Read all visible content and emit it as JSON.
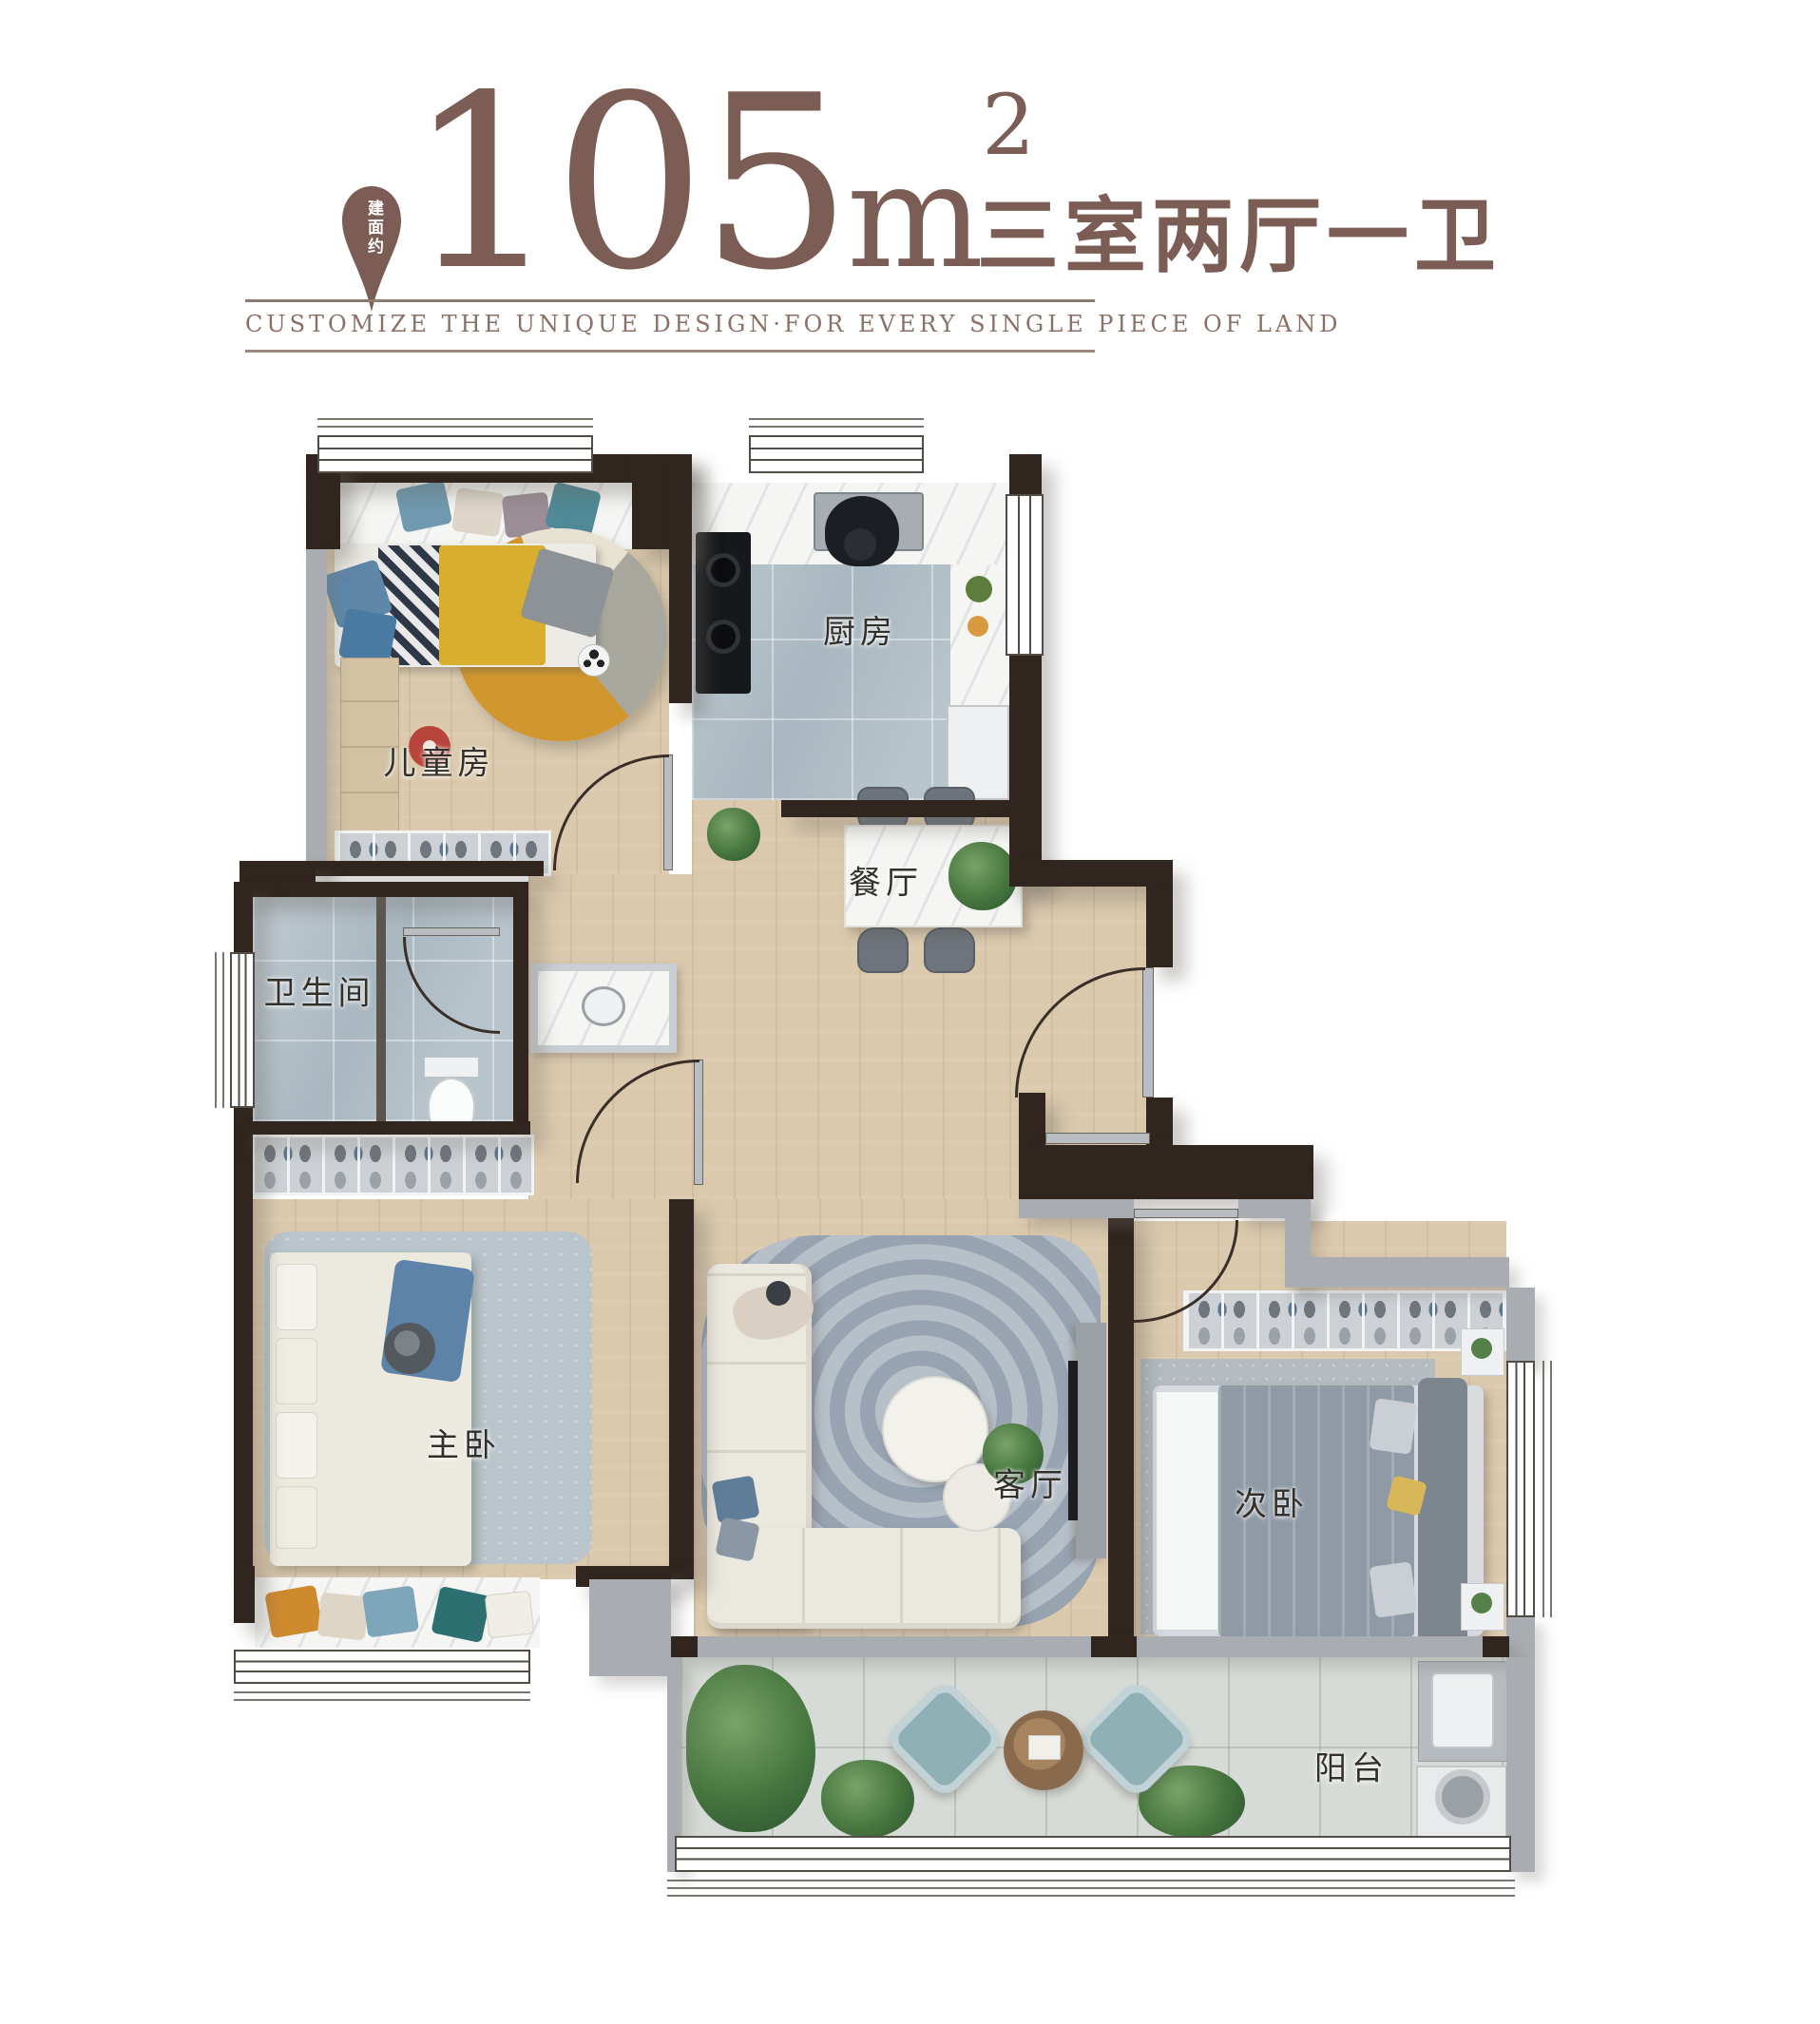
{
  "header": {
    "badge_text": "建面约",
    "area_number": "105",
    "area_unit": "m",
    "area_exponent": "2",
    "room_summary": "三室两厅一卫",
    "tagline": "CUSTOMIZE THE UNIQUE DESIGN·FOR EVERY SINGLE PIECE OF LAND"
  },
  "colors": {
    "brand_brown": "#7c5d55",
    "wall_dark": "#30251f",
    "wall_light": "#a9adb1",
    "wood_floor": "#dbc9ad",
    "tile_blue_gray": "#a9b7c0",
    "balcony_tile": "#d7dbd7",
    "kids_rug_yellow": "#d1972f",
    "living_rug_gray": "#a3aeba",
    "throw_blue": "#5e83a8"
  },
  "rooms": [
    {
      "id": "children",
      "label": "儿童房"
    },
    {
      "id": "kitchen",
      "label": "厨房"
    },
    {
      "id": "dining",
      "label": "餐厅"
    },
    {
      "id": "bathroom",
      "label": "卫生间"
    },
    {
      "id": "master",
      "label": "主卧"
    },
    {
      "id": "living",
      "label": "客厅"
    },
    {
      "id": "secondary",
      "label": "次卧"
    },
    {
      "id": "balcony",
      "label": "阳台"
    }
  ]
}
